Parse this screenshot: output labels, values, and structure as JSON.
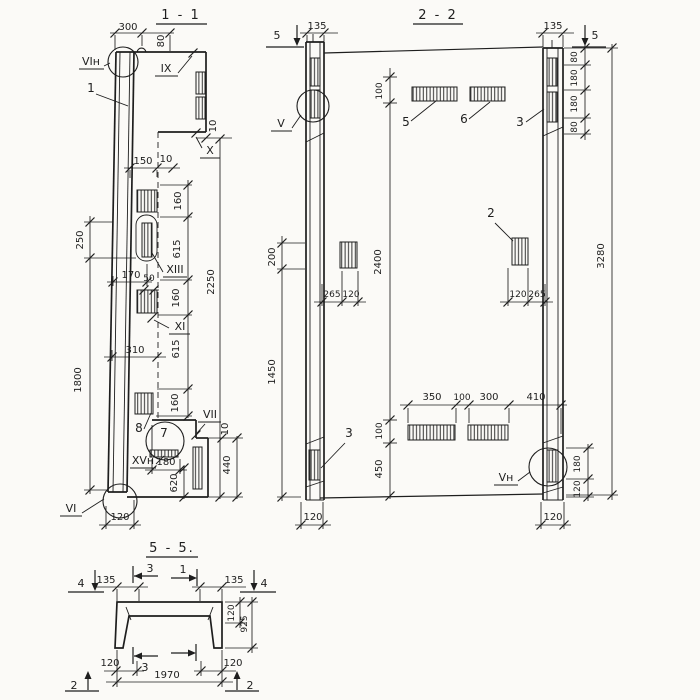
{
  "colors": {
    "paper": "#fbfaf7",
    "ink": "#1e1e1e"
  },
  "s11": {
    "title": "1 - 1",
    "labels": {
      "vin": "VIн",
      "part1": "1",
      "ix": "IX",
      "x": "X",
      "xiii": "XIII",
      "xi": "XI",
      "part8": "8",
      "part7": "7",
      "vii": "VII",
      "xvn": "XVн",
      "vi": "VI"
    },
    "dims": {
      "d300": "300",
      "d80": "80",
      "d150": "150",
      "d10a": "10",
      "d10step": "10",
      "d250": "250",
      "d1800": "1800",
      "d160a": "160",
      "d615a": "615",
      "d160b": "160",
      "d615b": "615",
      "d160c": "160",
      "d2250": "2250",
      "d170": "170",
      "d50": "50",
      "d310": "310",
      "d180": "180",
      "d620": "620",
      "d440": "440",
      "d10b": "10",
      "d120": "120"
    }
  },
  "s22": {
    "title": "2 - 2",
    "markers": {
      "m5l": "5",
      "m5r": "5"
    },
    "labels": {
      "v": "V",
      "p5": "5",
      "p6": "6",
      "b3r": "3",
      "p2": "2",
      "b3l": "3",
      "vn": "Vн"
    },
    "dims": {
      "d135l": "135",
      "d135r": "135",
      "d80t": "80",
      "d180t": "180",
      "d180m": "180",
      "d80m": "80",
      "d3280": "3280",
      "d100t": "100",
      "d200": "200",
      "d2400": "2400",
      "d265a": "265",
      "d120a": "120",
      "d120b": "120",
      "d265b": "265",
      "d1450": "1450",
      "d350": "350",
      "d100m": "100",
      "d300": "300",
      "d410": "410",
      "d100b": "100",
      "d450": "450",
      "d180r": "180",
      "d120r": "120",
      "d120cl": "120",
      "d120cr": "120"
    }
  },
  "s55": {
    "title": "5 - 5.",
    "markers": {
      "m4l": "4",
      "m4r": "4",
      "m3t": "3",
      "m1t": "1",
      "m3b": "3",
      "m2l": "2",
      "m2r": "2"
    },
    "dims": {
      "d135l": "135",
      "d135r": "135",
      "d120f": "120",
      "d925": "925",
      "d120bl": "120",
      "d120br": "120",
      "d1970": "1970"
    }
  }
}
